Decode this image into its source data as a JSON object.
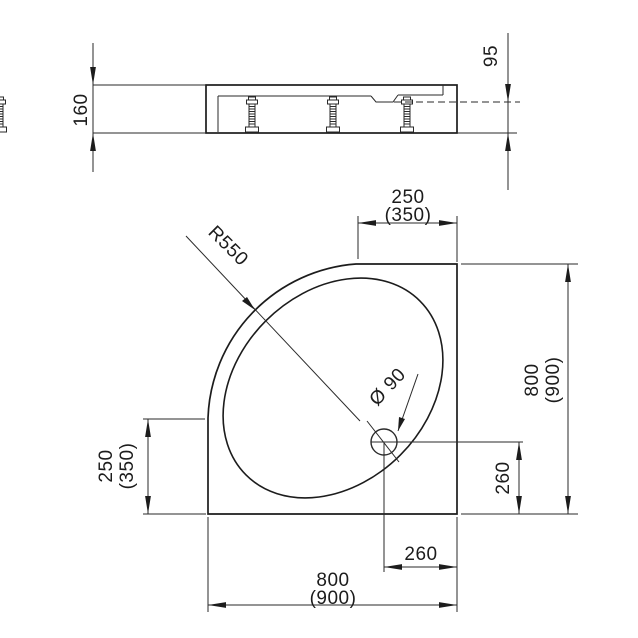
{
  "drawing": {
    "type": "technical-dimensional-drawing",
    "subject": "quadrant shower tray",
    "colors": {
      "line": "#1c1c1c",
      "background": "#ffffff"
    },
    "side_view": {
      "overall_height": "160",
      "basin_depth": "95"
    },
    "plan_view": {
      "corner_radius": "R550",
      "drain_diameter": "Ø 90",
      "top_width": "250",
      "top_width_alt": "(350)",
      "left_depth": "250",
      "left_depth_alt": "(350)",
      "right_height": "800",
      "right_height_alt": "(900)",
      "bottom_width": "800",
      "bottom_width_alt": "(900)",
      "drain_from_right_edge": "260",
      "drain_from_bottom_edge": "260"
    }
  }
}
